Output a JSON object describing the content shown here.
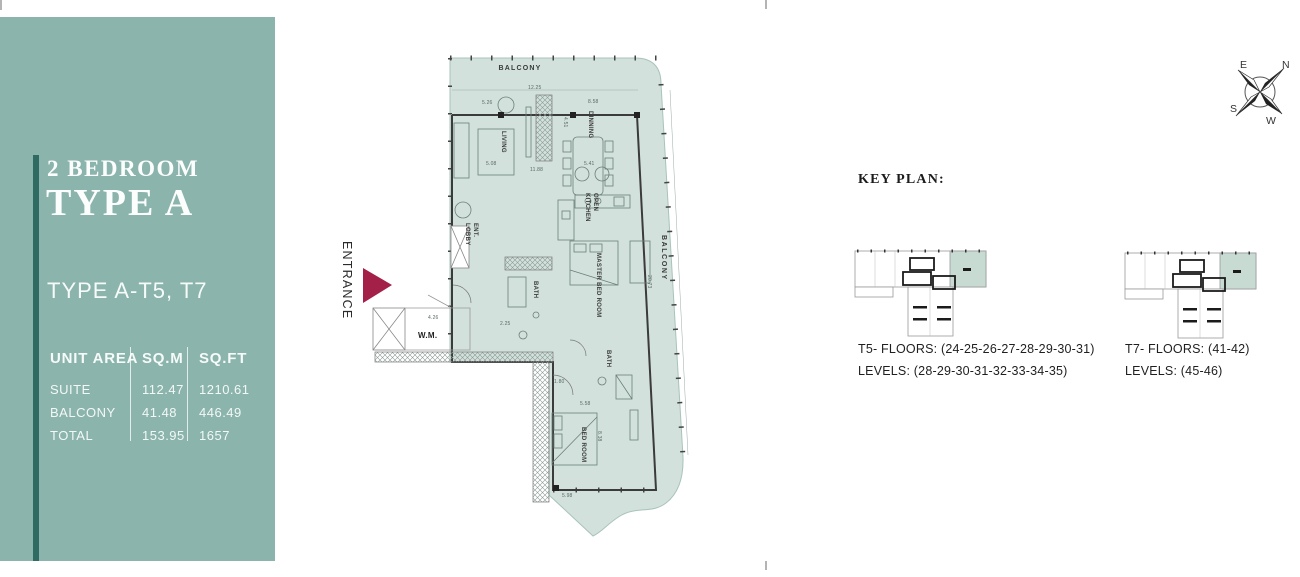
{
  "sidebar": {
    "title_line1": "2 BEDROOM",
    "title_line2": "TYPE A",
    "subtitle": "TYPE A-T5, T7",
    "table": {
      "headers": [
        "UNIT AREA",
        "SQ.M",
        "SQ.FT"
      ],
      "rows": [
        {
          "label": "SUITE",
          "sqm": "112.47",
          "sqft": "1210.61"
        },
        {
          "label": "BALCONY",
          "sqm": "41.48",
          "sqft": "446.49"
        },
        {
          "label": "TOTAL",
          "sqm": "153.95",
          "sqft": "1657"
        }
      ]
    },
    "colors": {
      "panel": "#8BB4AC",
      "stripe": "#2F6B63"
    }
  },
  "floor_plan": {
    "entrance_label": "ENTRANCE",
    "wm_label": "W.M.",
    "balcony_top": "BALCONY",
    "balcony_right": "BALCONY",
    "rooms": [
      "LIVING",
      "DINNING",
      "OPEN\nKITCHEN",
      "ENT.\nLOBBY",
      "BATH",
      "MASTER BED ROOM",
      "BATH",
      "BED ROOM"
    ],
    "dimensions": [
      "12.25",
      "5.26",
      "8.58",
      "4.51",
      "11.88",
      "5.08",
      "5.41",
      "4.26",
      "2.25",
      "1.80",
      "5.58",
      "8.38",
      "5.98",
      "20.73"
    ],
    "colors": {
      "fill": "#D2E1DB",
      "wall": "#3B3B3B",
      "entrance_arrow": "#A32148"
    }
  },
  "key_plan": {
    "heading": "KEY PLAN:",
    "items": [
      {
        "floors": "T5- FLOORS: (24-25-26-27-28-29-30-31)",
        "levels": "LEVELS: (28-29-30-31-32-33-34-35)"
      },
      {
        "floors": "T7- FLOORS: (41-42)",
        "levels": "LEVELS: (45-46)"
      }
    ]
  },
  "compass": {
    "n": "N",
    "e": "E",
    "s": "S",
    "w": "W"
  }
}
